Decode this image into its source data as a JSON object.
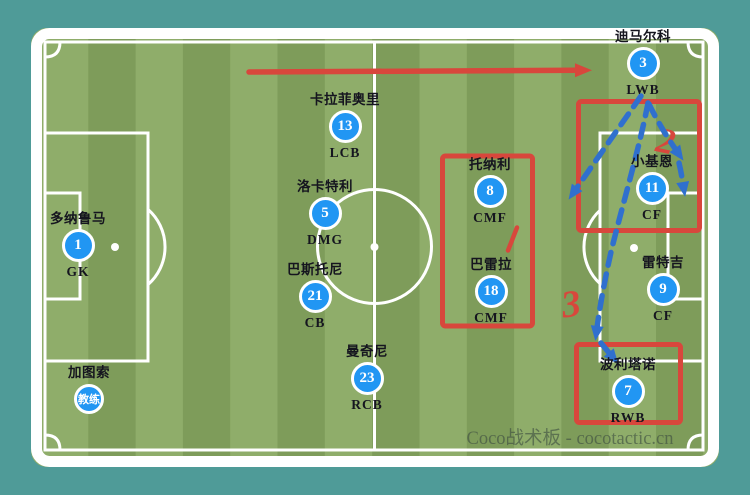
{
  "watermark": "Coco战术板 - cocotactic.cn",
  "colors": {
    "background_teal": "#4F9B98",
    "pitch_light_green": "#8FAD6A",
    "pitch_dark_green": "#7E9C5A",
    "player_circle_blue": "#2196F3",
    "annotation_red": "#D8473C",
    "annotation_blue": "#3070CE"
  },
  "players": [
    {
      "name": "多纳鲁马",
      "number": "1",
      "position": "GK"
    },
    {
      "name": "卡拉菲奥里",
      "number": "13",
      "position": "LCB"
    },
    {
      "name": "洛卡特利",
      "number": "5",
      "position": "DMG"
    },
    {
      "name": "巴斯托尼",
      "number": "21",
      "position": "CB"
    },
    {
      "name": "曼奇尼",
      "number": "23",
      "position": "RCB"
    },
    {
      "name": "托纳利",
      "number": "8",
      "position": "CMF"
    },
    {
      "name": "巴雷拉",
      "number": "18",
      "position": "CMF"
    },
    {
      "name": "迪马尔科",
      "number": "3",
      "position": "LWB"
    },
    {
      "name": "小基恩",
      "number": "11",
      "position": "CF"
    },
    {
      "name": "雷特吉",
      "number": "9",
      "position": "CF"
    },
    {
      "name": "波利塔诺",
      "number": "7",
      "position": "RWB"
    }
  ],
  "coach": {
    "name": "加图索",
    "badge": "教练"
  },
  "annotations": {
    "digit_2": "2",
    "digit_3": "3"
  }
}
